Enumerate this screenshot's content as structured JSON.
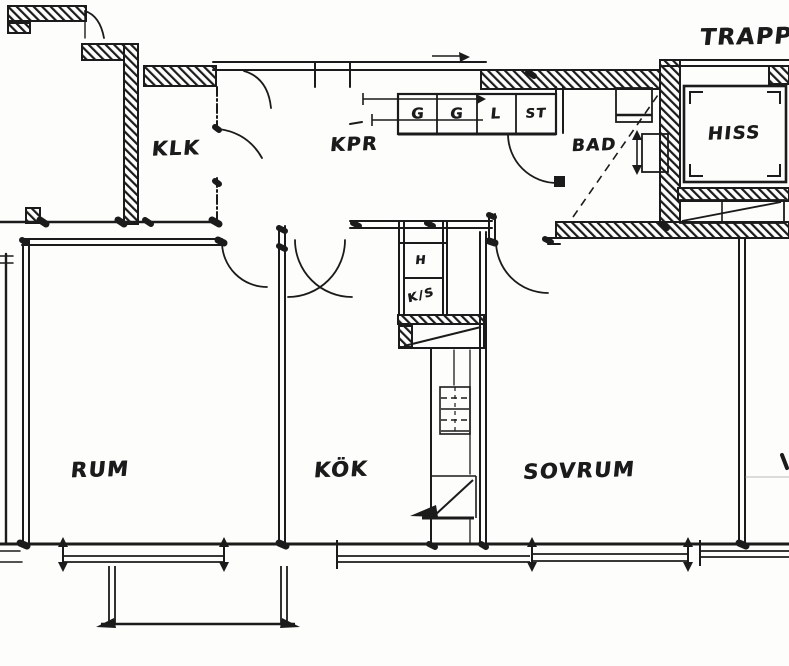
{
  "colors": {
    "ink": "#1b1b1b",
    "paper": "#fdfdfb"
  },
  "labels": {
    "stairwell": "TRAPPH",
    "closet": "KLK",
    "hall": "KPR",
    "bath": "BAD",
    "elevator": "HISS",
    "room": "RUM",
    "kitchen": "KÖK",
    "bedroom": "SOVRUM",
    "vent_hood": "H",
    "fridge_cool": "K/S",
    "cabinets": [
      "G",
      "G",
      "L",
      "ST"
    ]
  }
}
